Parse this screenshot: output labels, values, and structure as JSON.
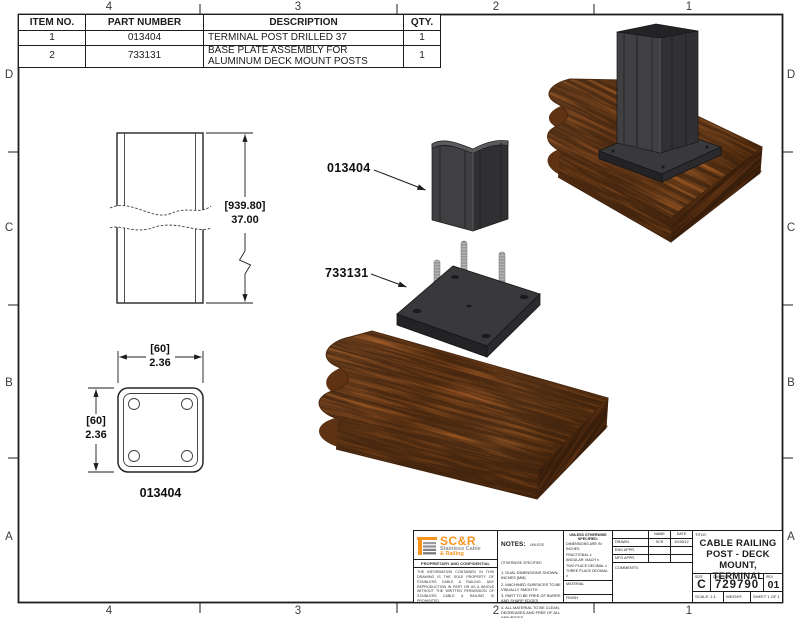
{
  "palette": {
    "line": "#1c1c1c",
    "brand_orange": "#f7941d",
    "brand_gray": "#8d8f92",
    "metal_dark": "#3e3e40",
    "wood_brown": "#96551f"
  },
  "zones": {
    "top": [
      "4",
      "3",
      "2",
      "1"
    ],
    "bottom": [
      "4",
      "3",
      "2",
      "1"
    ],
    "left": [
      "D",
      "C",
      "B",
      "A"
    ],
    "right": [
      "D",
      "C",
      "B",
      "A"
    ]
  },
  "bom": {
    "headers": [
      "ITEM NO.",
      "PART NUMBER",
      "DESCRIPTION",
      "QTY."
    ],
    "rows": [
      {
        "item": "1",
        "part": "013404",
        "desc": "TERMINAL POST DRILLED 37",
        "qty": "1"
      },
      {
        "item": "2",
        "part": "733131",
        "desc": "BASE PLATE ASSEMBLY FOR ALUMINUM DECK MOUNT POSTS",
        "qty": "1"
      }
    ]
  },
  "views": {
    "side": {
      "dim_metric": "[939.80]",
      "dim_inch": "37.00"
    },
    "section": {
      "top_metric": "[60]",
      "top_inch": "2.36",
      "left_metric": "[60]",
      "left_inch": "2.36",
      "caption": "013404"
    },
    "exploded": {
      "post_label": "013404",
      "plate_label": "733131"
    }
  },
  "title_block": {
    "logo": {
      "brand": "SC&R",
      "tagline1": "Stainless Cable",
      "tagline2": "& Railing"
    },
    "proprietary": {
      "heading": "PROPRIETARY AND CONFIDENTIAL",
      "body": "THE INFORMATION CONTAINED IN THIS DRAWING IS THE SOLE PROPERTY OF STAINLESS CABLE & RAILING. ANY REPRODUCTION IN PART OR AS A WHOLE WITHOUT THE WRITTEN PERMISSION OF STAINLESS CABLE & RAILING IS PROHIBITED."
    },
    "notes": {
      "heading": "NOTES:",
      "qualifier": "UNLESS OTHERWISE SPECIFIED",
      "items": [
        "1. DUAL DIMENSIONS SHOWN: INCHES [MM]",
        "2. MACHINED SURFACES TO BE VISUALLY SMOOTH",
        "3. PART TO BE FREE OF BURRS AND SHARP EDGES",
        "4. ALL MATERIAL TO BE CLEAN, DEGREASED AND FREE OF ALL IMPURITIES",
        "5. ANY CHANGE MUST BE AUTHORIZED BY AN SC&R ENGINEER"
      ]
    },
    "tolerances": {
      "heading": "UNLESS OTHERWISE SPECIFIED:",
      "lines": [
        "DIMENSIONS ARE IN INCHES",
        "FRACTIONAL ±",
        "ANGULAR: MACH ±",
        "TWO PLACE DECIMAL ±",
        "THREE PLACE DECIMAL ±"
      ],
      "material_label": "MATERIAL",
      "finish_label": "FINISH"
    },
    "approvals": {
      "name_header": "NAME",
      "date_header": "DATE",
      "rows": [
        {
          "label": "DRAWN",
          "name": "SCR",
          "date": "10/26/12"
        },
        {
          "label": "ENG APPR.",
          "name": "",
          "date": ""
        },
        {
          "label": "MFG APPR.",
          "name": "",
          "date": ""
        }
      ],
      "comments_label": "COMMENTS:"
    },
    "title": {
      "label": "TITLE:",
      "line1": "CABLE RAILING",
      "line2": "POST - DECK",
      "line3": "MOUNT, TERMINAL"
    },
    "ids": {
      "size_label": "SIZE",
      "size": "C",
      "dwg_label": "DWG. NO.",
      "dwg_no": "729790",
      "rev_label": "REV",
      "rev": "01",
      "scale": "SCALE: 1:1",
      "weight": "WEIGHT:",
      "sheet": "SHEET 1 OF 1"
    }
  }
}
